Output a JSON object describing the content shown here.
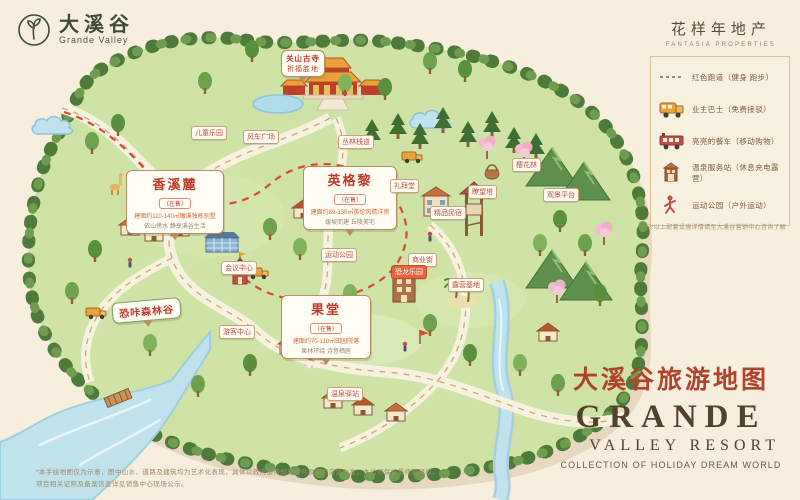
{
  "brand": {
    "name_cn": "大溪谷",
    "name_en": "Grande Valley"
  },
  "developer": {
    "name_cn": "花样年地产",
    "name_en": "FANTASIA PROPERTIES"
  },
  "legend": {
    "items": [
      {
        "icon": "dashed-track-icon",
        "label": "红色跑道（健身 跑步）"
      },
      {
        "icon": "owner-bus-icon",
        "label": "业主巴士（免费接驳）"
      },
      {
        "icon": "dining-car-icon",
        "label": "亮亮的餐车（移动购物）"
      },
      {
        "icon": "service-station-icon",
        "label": "温泉服务站（休息充电露营）"
      },
      {
        "icon": "sports-park-icon",
        "label": "运动公园（户外运动）"
      }
    ],
    "note": "※以上配套设施详情请至大溪谷营销中心咨询了解"
  },
  "title_block": {
    "cn": "大溪谷旅游地图",
    "en_line1": "GRANDE",
    "en_line2": "VALLEY RESORT",
    "en_line3": "COLLECTION OF HOLIDAY DREAM WORLD"
  },
  "bubbles": [
    {
      "title": "香溪麓",
      "status": "（在售）",
      "line1": "建面约110-140㎡瞰溪独栋别墅",
      "line2": "依山傍水 静享溪谷生活"
    },
    {
      "title": "英格黎",
      "status": "（在售）",
      "line1": "建面约89-130㎡英伦风情洋房",
      "line2": "缓坡而建 丘陵美宅"
    },
    {
      "title": "果堂",
      "status": "（在售）",
      "line1": "建面约70-110㎡田园院落",
      "line2": "果林环绕 诗意栖居"
    },
    {
      "title": "恐咔森林谷"
    },
    {
      "title": "关山古寺",
      "line1": "祈福胜地"
    }
  ],
  "flags": [
    "儿童乐园",
    "风车广场",
    "丛林栈道",
    "礼拜堂",
    "精品民宿",
    "瞭望塔",
    "樱花林",
    "观景平台",
    "商业街",
    "恐龙乐园",
    "会议中心",
    "游客中心",
    "运动公园",
    "露营基地",
    "温泉驿站"
  ],
  "footnotes": {
    "line1": "*本手绘地图仅为示意，图中山水、道路及建筑均为艺术化表现，具体以政府最终规划文件及项目实景为准，本公司保留最终解释权。",
    "line2": "项目相关证照及备案信息详见销售中心现场公示。"
  },
  "colors": {
    "background": "#f7eedd",
    "map_green": "#cfe3a6",
    "tree_green": "#4e7b3c",
    "water_blue": "#bfe2ec",
    "road_cream": "#f7f2df",
    "track_red": "#d44a36",
    "label_red": "#c03a2b",
    "title_red": "#b0432c",
    "title_brown": "#53402d",
    "accent_orange": "#e8a33d"
  }
}
